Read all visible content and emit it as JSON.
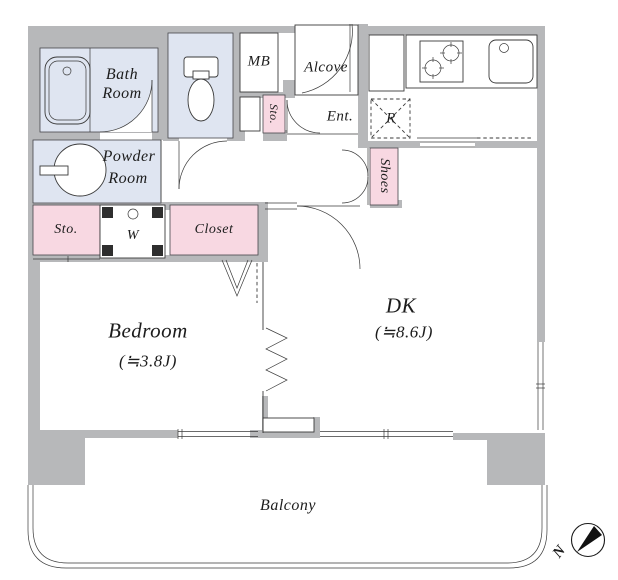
{
  "floorplan": {
    "colors": {
      "wall_gray": "#b7b8ba",
      "wet_area_blue": "#dfe5f1",
      "storage_pink": "#f8d8e2"
    },
    "rooms": {
      "bath": {
        "line1": "Bath",
        "line2": "Room"
      },
      "meter_box": "MB",
      "alcove": "Alcove",
      "entrance_storage": "Sto.",
      "entrance": "Ent.",
      "refrigerator_space": "R",
      "powder": {
        "line1": "Powder",
        "line2": "Room"
      },
      "shoe_cabinet": "Shoes",
      "storage": "Sto.",
      "washer": "W",
      "closet": "Closet",
      "bedroom": {
        "name": "Bedroom",
        "size": "(≒3.8J)"
      },
      "dining_kitchen": {
        "name": "DK",
        "size": "(≒8.6J)"
      },
      "balcony": "Balcony"
    },
    "compass": {
      "north_label": "N"
    }
  }
}
